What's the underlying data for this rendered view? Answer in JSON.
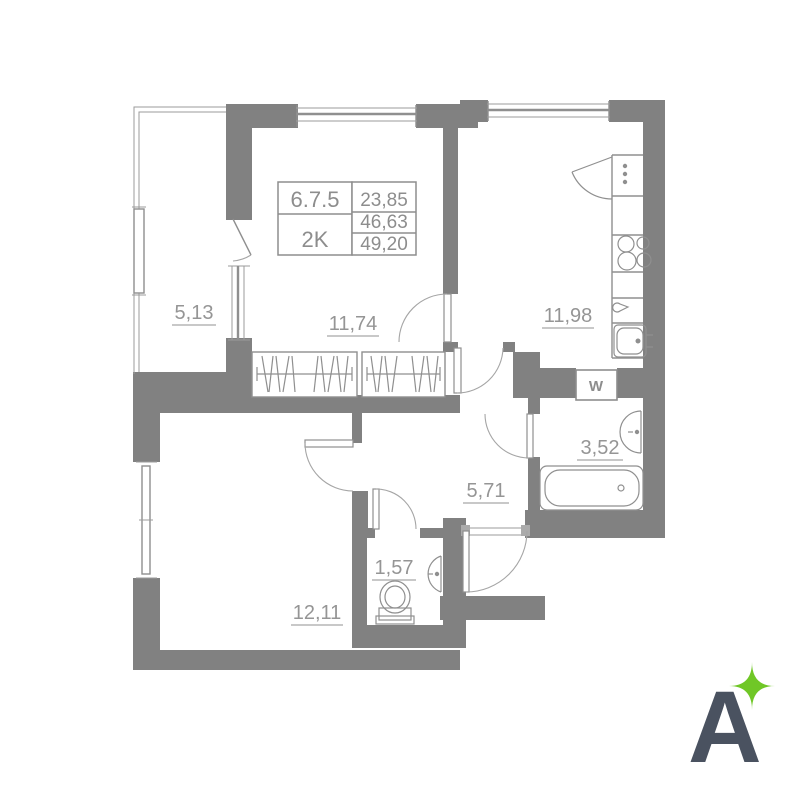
{
  "info": {
    "unit_number": "6.7.5",
    "unit_type": "2K",
    "areas": [
      "23,85",
      "46,63",
      "49,20"
    ]
  },
  "rooms": {
    "balcony": {
      "area": "5,13"
    },
    "living": {
      "area": "11,74"
    },
    "kitchen": {
      "area": "11,98"
    },
    "hallway": {
      "area": "5,71"
    },
    "bathroom": {
      "area": "3,52"
    },
    "wc": {
      "area": "1,57"
    },
    "bedroom": {
      "area": "12,11"
    }
  },
  "fixtures": {
    "washing_machine_label": "W"
  },
  "logo": {
    "letter": "A",
    "letter_color": "#4a5260",
    "star_color": "#70c727"
  },
  "colors": {
    "wall": "#818181",
    "line": "#8f8f8f",
    "label_text": "#959595"
  }
}
